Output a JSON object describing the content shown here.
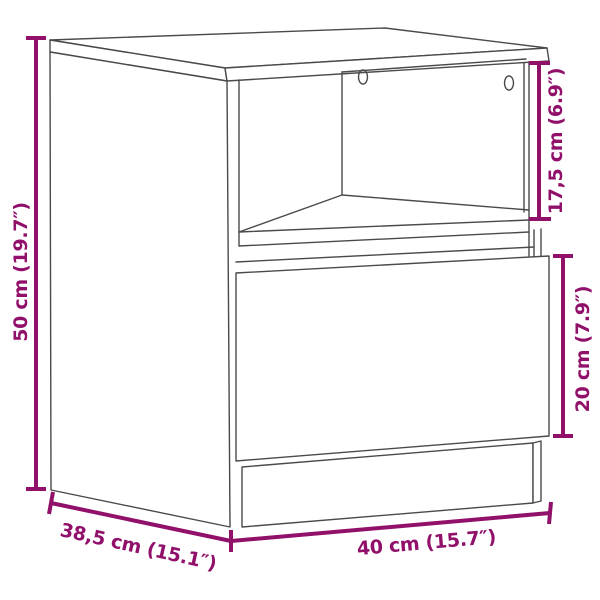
{
  "colors": {
    "background": "#ffffff",
    "line_art": "#4a4a4a",
    "dimension": "#91106a"
  },
  "subject": "nightstand with open compartment and drawer",
  "dimensions": {
    "height": {
      "label": "50 cm (19.7″)"
    },
    "opening_height": {
      "label": "17,5 cm (6.9″)"
    },
    "drawer_height": {
      "label": "20 cm (7.9″)"
    },
    "width": {
      "label": "40 cm (15.7″)"
    },
    "depth": {
      "label": "38,5 cm (15.1″)"
    }
  }
}
